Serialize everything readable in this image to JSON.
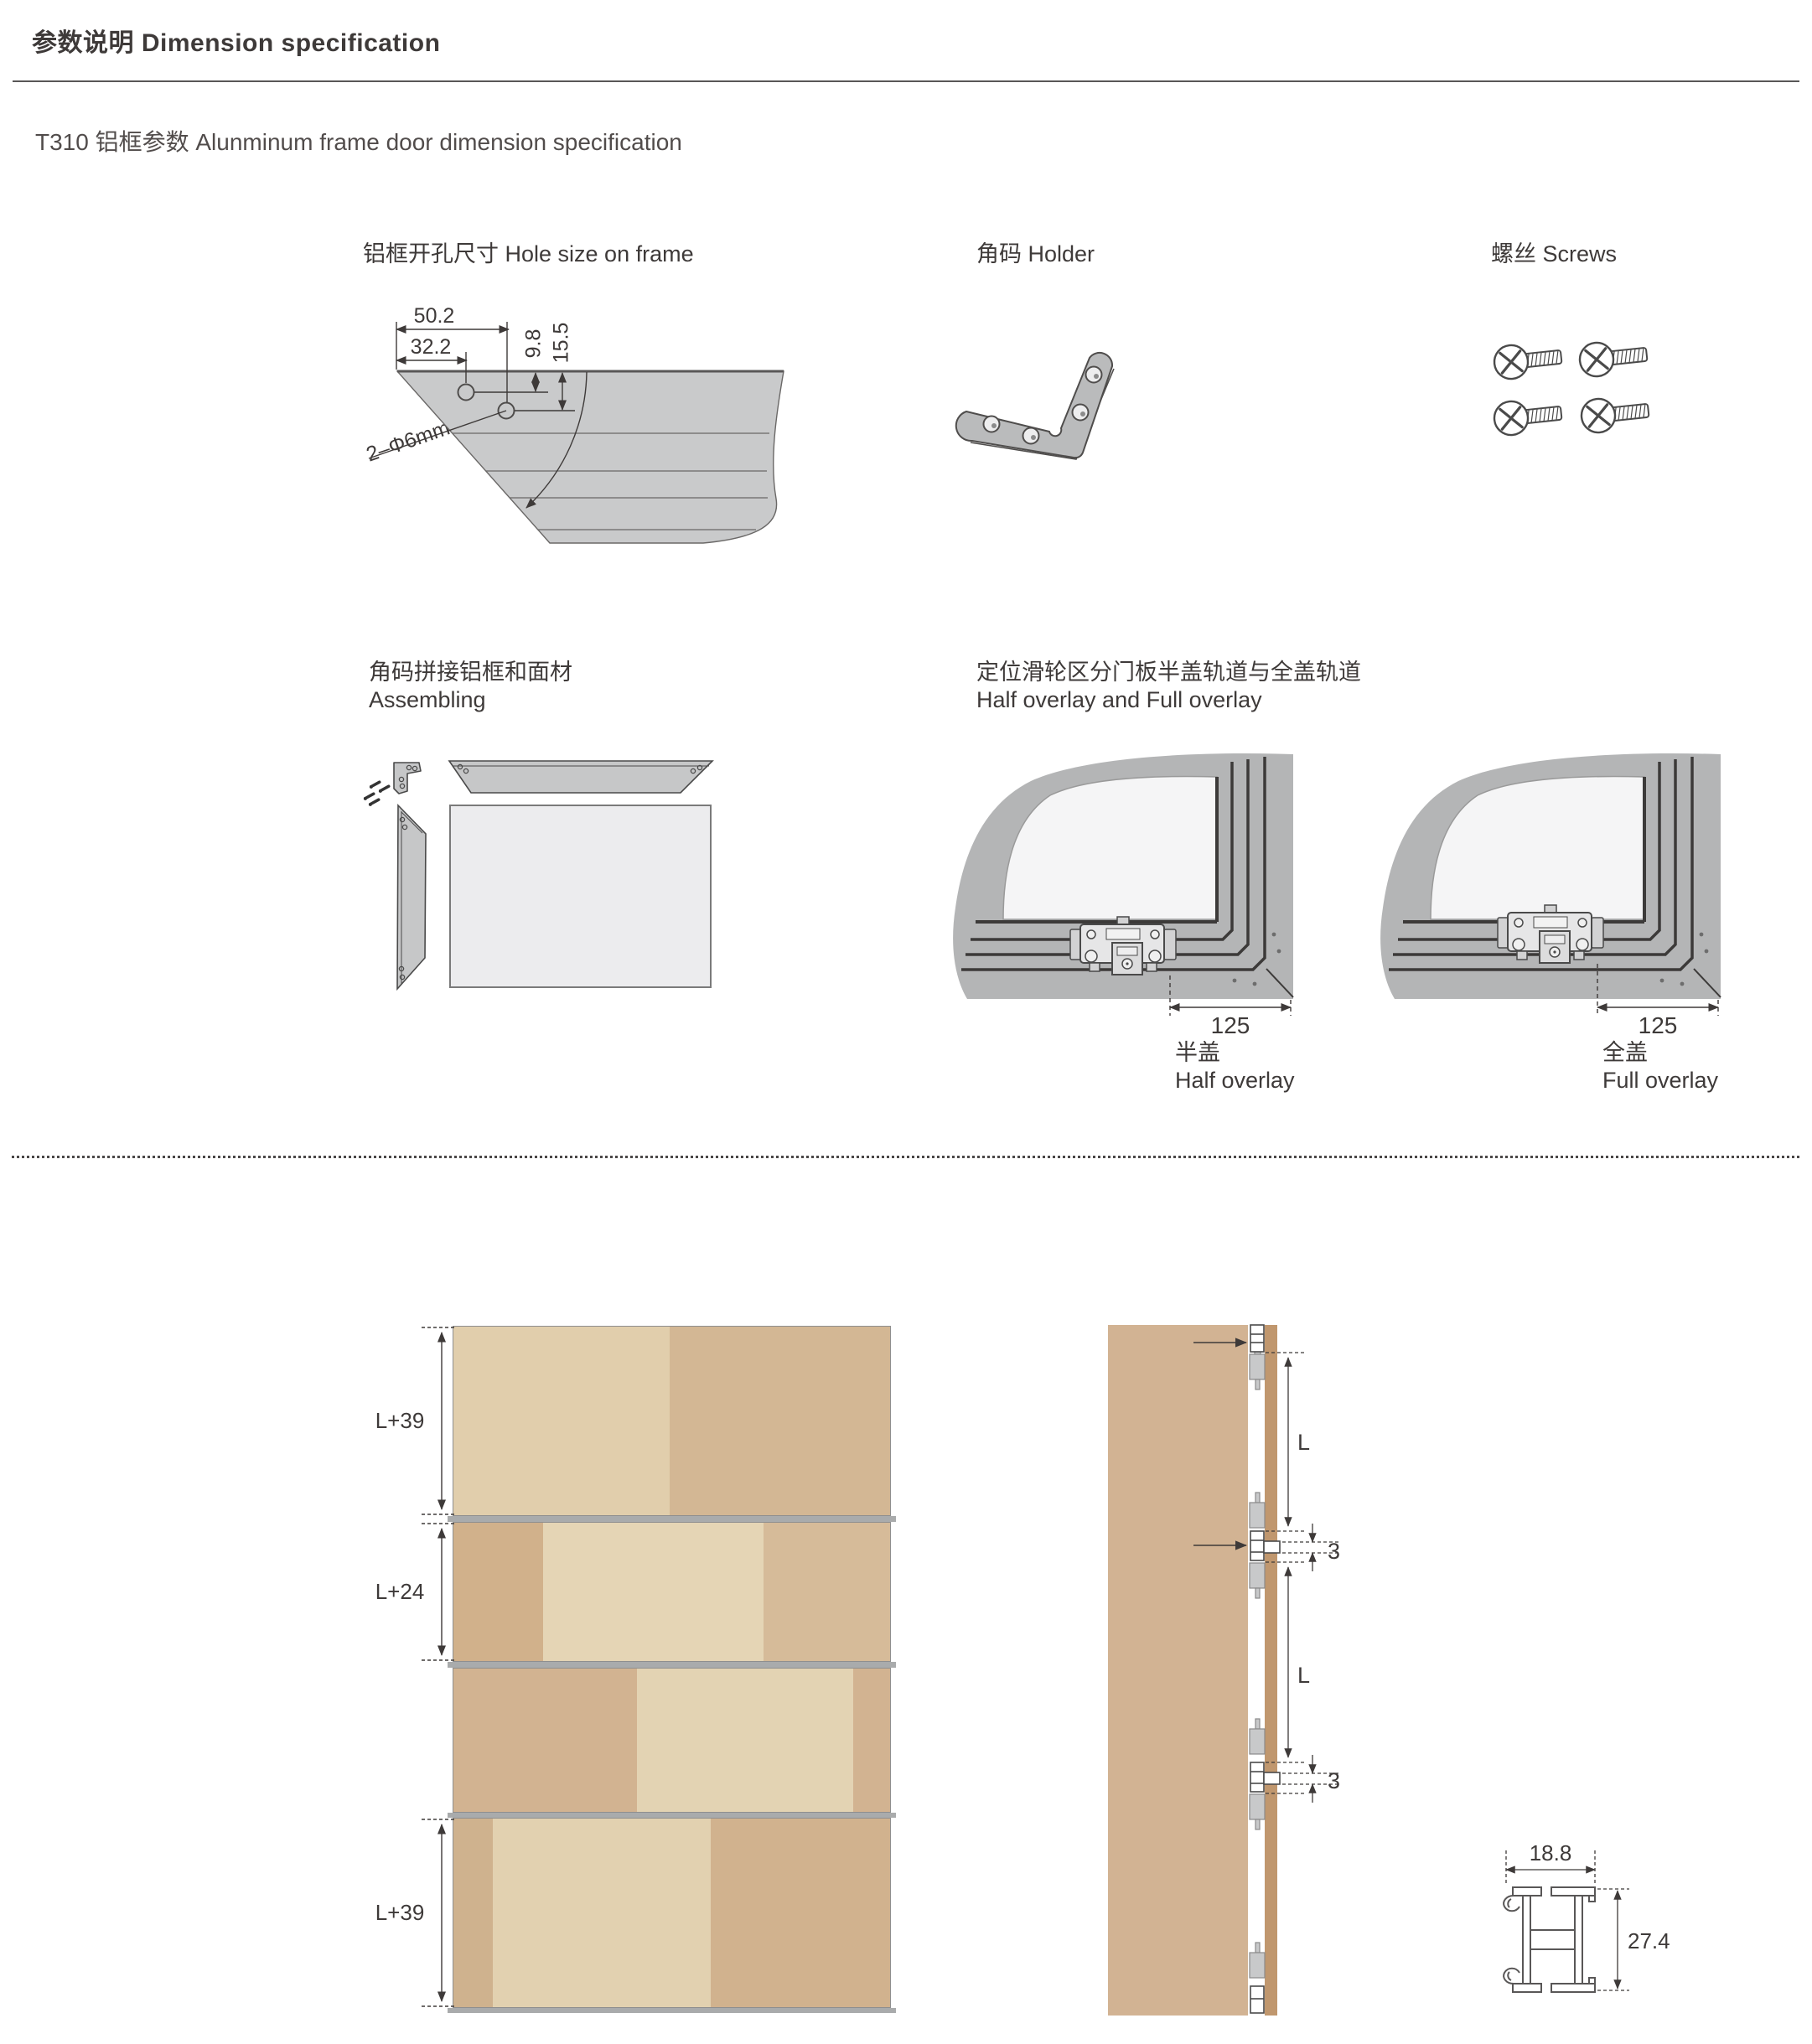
{
  "header": {
    "title": "参数说明 Dimension specification"
  },
  "subtitle": "T310 铝框参数 Alunminum frame door dimension specification",
  "hole_size": {
    "title": "铝框开孔尺寸 Hole size on frame",
    "dim_width_outer": "50.2",
    "dim_width_inner": "32.2",
    "dim_depth_1": "9.8",
    "dim_depth_2": "15.5",
    "dim_angle": "45°",
    "dim_holes": "2–Φ6mm"
  },
  "holder": {
    "title": "角码 Holder"
  },
  "screws": {
    "title": "螺丝 Screws"
  },
  "assembling": {
    "title_zh": "角码拼接铝框和面材",
    "title_en": "Assembling"
  },
  "overlay": {
    "title_zh": "定位滑轮区分门板半盖轨道与全盖轨道",
    "title_en": "Half overlay and Full overlay",
    "half": {
      "dim": "125",
      "label_zh": "半盖",
      "label_en": "Half overlay"
    },
    "full": {
      "dim": "125",
      "label_zh": "全盖",
      "label_en": "Full overlay"
    }
  },
  "door_panels": {
    "dims": [
      "L+39",
      "L+24",
      "L+39"
    ]
  },
  "side_view": {
    "full_zh": "全盖",
    "full_en": "Full overlay",
    "half_zh": "半盖",
    "half_en": "Half overlay",
    "dim_l": "L",
    "dim_gap": "3"
  },
  "profile": {
    "dim_w": "18.8",
    "dim_h": "27.4"
  },
  "colors": {
    "text": "#3e3a39",
    "line": "#595757",
    "drawing_gray": "#c9cacb",
    "frame_gray": "#b4b5b6",
    "panel_face": "#ececee",
    "wood_light": "#e3d2b2",
    "wood_mid": "#d3b795",
    "wood_dark": "#d1b18b",
    "side_panel": "#d2b393",
    "door_edge": "#c0976e",
    "track_bar": "#a9abac"
  }
}
